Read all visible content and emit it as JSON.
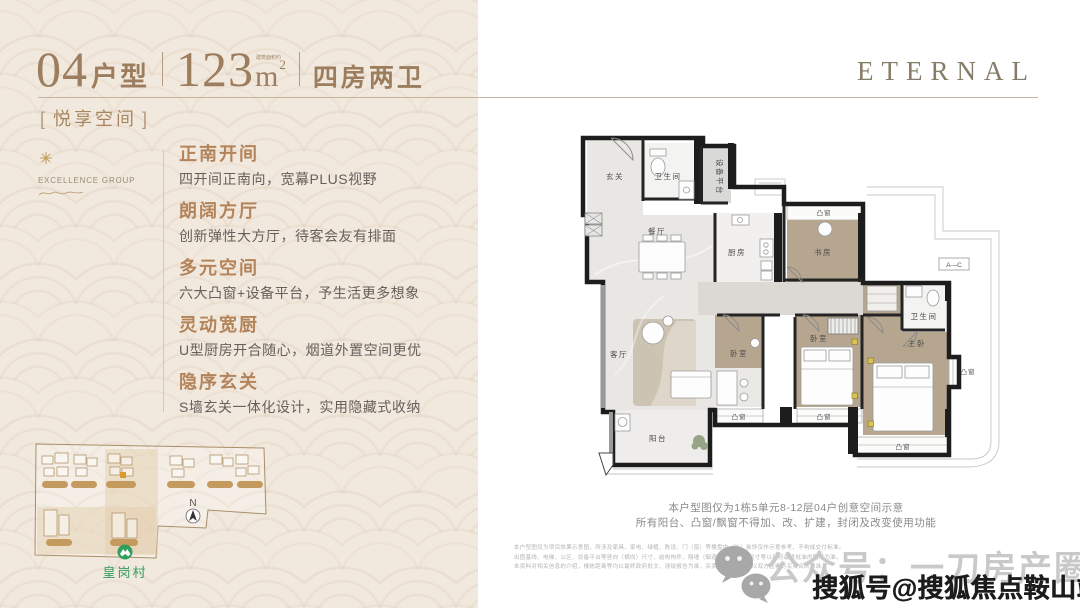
{
  "header": {
    "unit_number": "04",
    "unit_label": "户型",
    "area_note": "建筑面积约",
    "area_value": "123",
    "area_unit": "m",
    "area_exp": "2",
    "rooms_label": "四房两卫",
    "bracket_l": "[",
    "bracket_r": "]",
    "tagline": "悦享空间"
  },
  "brand": {
    "left_logo": "EXCELLENCE GROUP",
    "right_logo": "ETERNAL"
  },
  "features": [
    {
      "title": "正南开间",
      "desc": "四开间正南向，宽幕PLUS视野"
    },
    {
      "title": "朗阔方厅",
      "desc": "创新弹性大方厅，待客会友有排面"
    },
    {
      "title": "多元空间",
      "desc": "六大凸窗+设备平台，予生活更多想象"
    },
    {
      "title": "灵动宽厨",
      "desc": "U型厨房开合随心，烟道外置空间更优"
    },
    {
      "title": "隐序玄关",
      "desc": "S墙玄关一体化设计，实用隐藏式收纳"
    }
  ],
  "sitemap": {
    "north": "N",
    "station": "皇岗村"
  },
  "floorplan": {
    "labels": {
      "entry": "玄关",
      "bath1": "卫生间",
      "equipment": "设备平台",
      "dining": "餐厅",
      "kitchen": "厨房",
      "study": "书房",
      "bath2": "卫生间",
      "living": "客厅",
      "balcony": "阳台",
      "bedroom1": "卧室",
      "bedroom2": "卧室",
      "master": "主卧",
      "bay": "凸窗",
      "marker": "A—C"
    }
  },
  "caption": {
    "line1": "本户型图仅为1栋5单元8-12层04户创意空间示意",
    "line2": "所有阳台、凸窗/飘窗不得加、改、扩建，封闭及改变使用功能"
  },
  "disclaimer": {
    "line1": "本户型图仅为项目效果示意图，所涉及家具、家电、绿植、陈设、门（窗）等楼盘内（外）装饰仅作示意参考，不构成交付标准。",
    "line2": "出图基线、电梯、公区、设备平台等竖向（横向）尺寸，结构构件、隔墙（烟道尺寸）、门洞尺寸等以政府最终批准的图纸为准。",
    "line3": "本资料对相关信息的介绍，楼栋距离等均以最终政府批文、测绘报告为准，买卖双方权利义务以双方签署的买卖合同为准。"
  },
  "watermark": {
    "wechat_account": "公众号：一刀房产圈",
    "sohu_account": "搜狐号@搜狐焦点鞍山站"
  }
}
